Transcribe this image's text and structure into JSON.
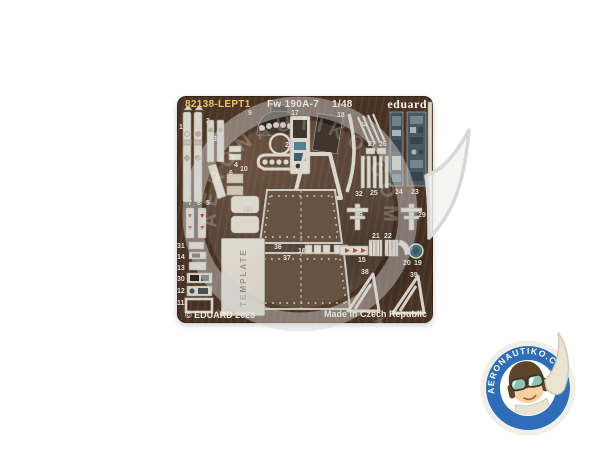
{
  "product": {
    "catalog_number": "82138-LEPT1",
    "subject": "Fw 190A-7",
    "scale": "1/48",
    "brand": "eduard",
    "copyright": "© EDUARD 2023",
    "origin": "Made in Czech Republic",
    "template_label": "TEMPLATE"
  },
  "fret": {
    "material": "photo-etched brass sheet, dark brown",
    "part_numbers": [
      "1",
      "2",
      "3",
      "4",
      "6",
      "10",
      "7",
      "8",
      "5",
      "33",
      "31",
      "14",
      "13",
      "30",
      "12",
      "11",
      "9",
      "17",
      "18",
      "28",
      "34",
      "27",
      "26",
      "32",
      "25",
      "24",
      "23",
      "29",
      "29",
      "21",
      "22",
      "15",
      "20",
      "19",
      "36",
      "16",
      "37",
      "38",
      "39"
    ]
  },
  "watermark": {
    "site": "AERONAUTIKO.COM",
    "stars": "★ ★ ★ ★ ★ ★ ★ ★ ★"
  },
  "colors": {
    "fret_brown": "#4c3526",
    "metal_part": "#d8d4c8",
    "catalog_yellow": "#e8c75a",
    "badge_blue": "#2f6db8",
    "console_slate": "#46525a",
    "teal_print": "#3a7484",
    "red_mark": "#b5301f",
    "watermark_gray": "#d4d4d4"
  }
}
